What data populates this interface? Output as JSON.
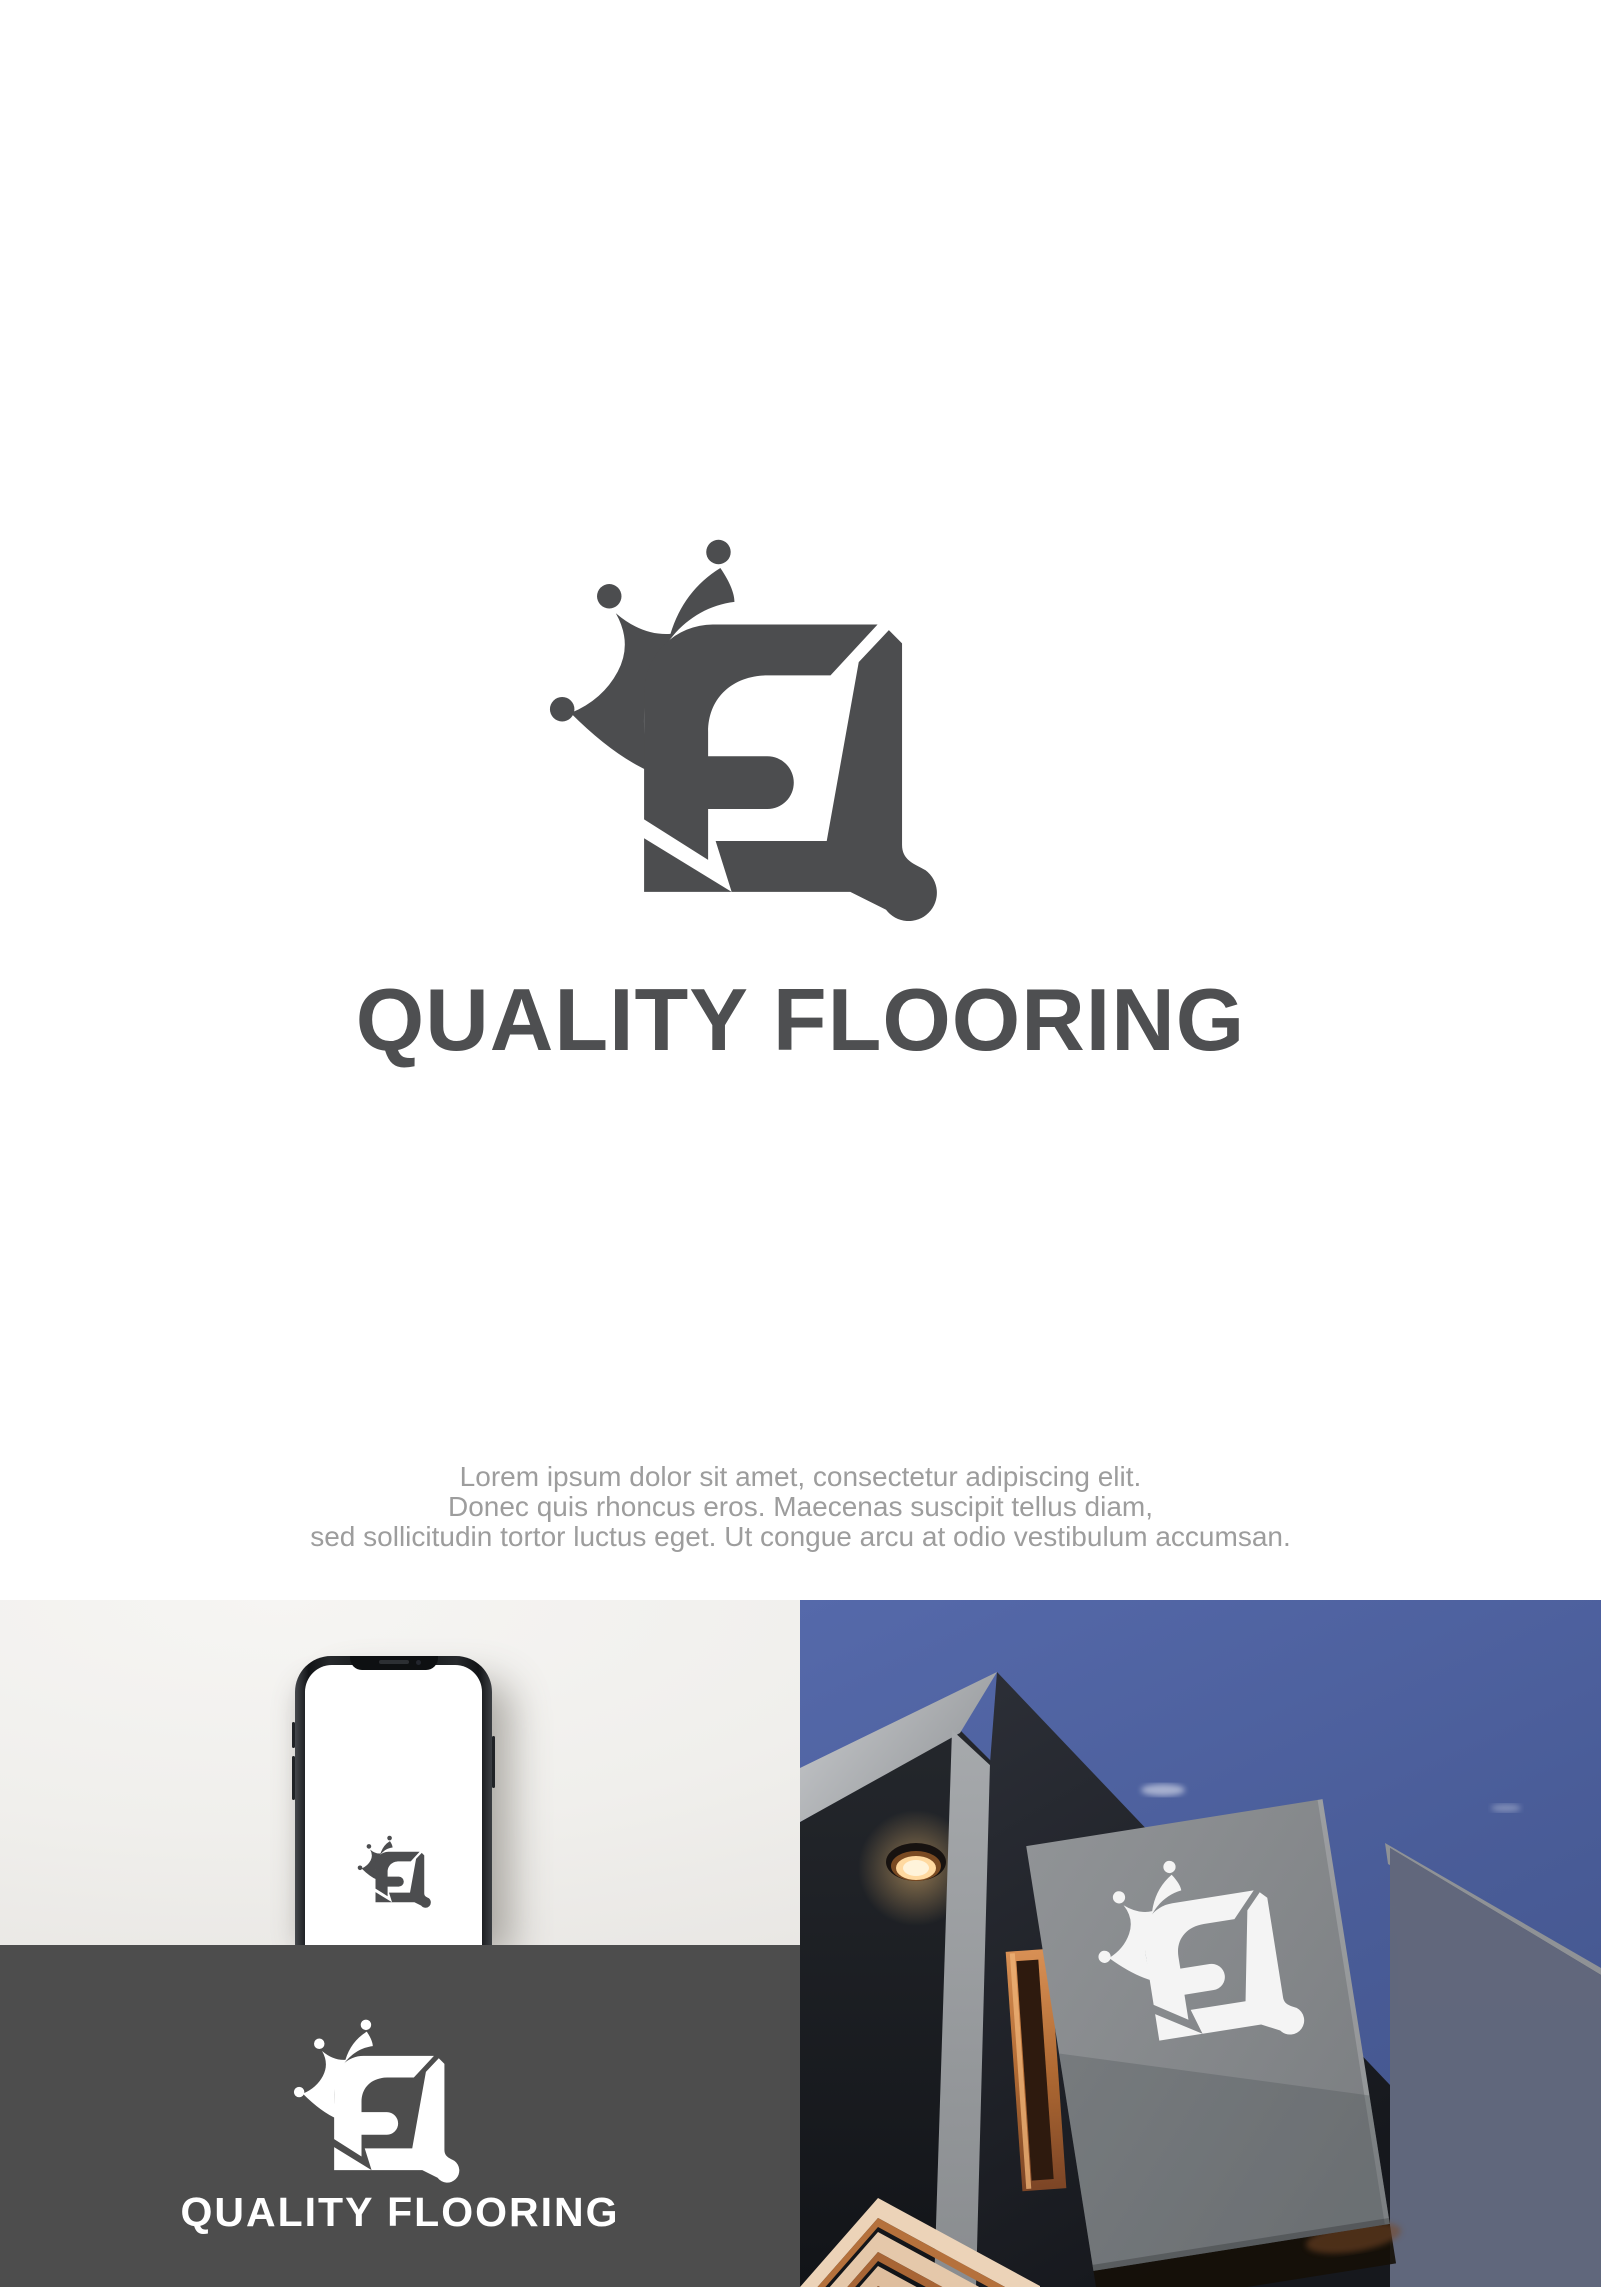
{
  "brand": {
    "name": "QUALITY FLOORING",
    "logo_icon": "crown-fq-magnifier-monogram"
  },
  "header": {
    "title": "QUALITY FLOORING"
  },
  "tagline": {
    "line1": "Lorem ipsum dolor sit amet, consectetur adipiscing elit.",
    "line2": "Donec quis rhoncus eros. Maecenas suscipit tellus diam,",
    "line3": "sed sollicitudin tortor luctus eget. Ut congue arcu at odio vestibulum accumsan."
  },
  "mockups": {
    "dark_panel": {
      "wordmark": "QUALITY FLOORING"
    }
  },
  "colors": {
    "brand_gray": "#4c4d4f",
    "title_gray": "#4e4f51",
    "tagline_gray": "#9d9d9d",
    "dark_panel_bg": "#4d4d4d",
    "wall_light": "#f1f0ed",
    "sky_blue": "#5166a5",
    "sign_gray": "#85888b",
    "copper": "#b5713c",
    "logo_white": "#ffffff"
  }
}
